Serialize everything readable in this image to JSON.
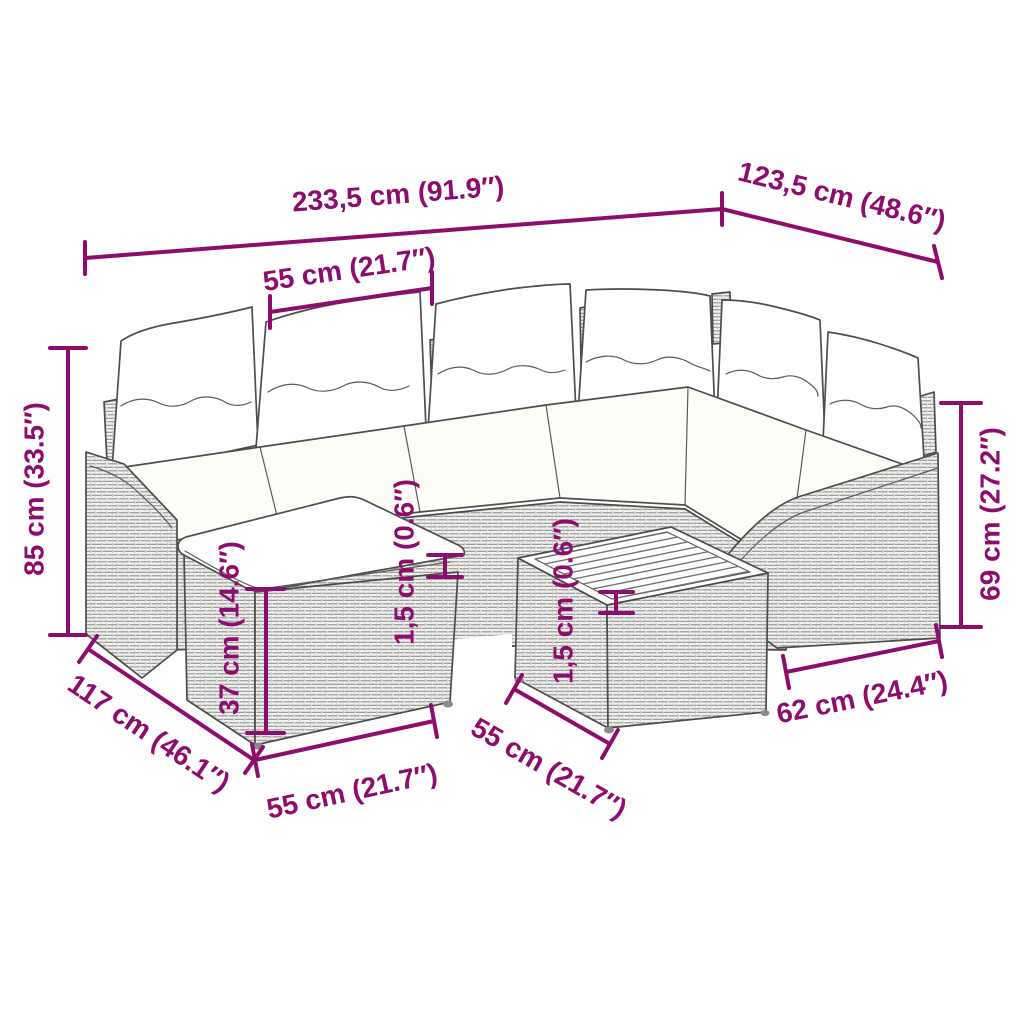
{
  "diagram": {
    "accent_color": "#8D0C6E",
    "outline_color": "#4b4b4b",
    "dimensions": {
      "total_width": "233,5 cm (91.9″)",
      "right_depth": "123,5 cm (48.6″)",
      "seat_width": "55 cm (21.7″)",
      "overall_height": "85 cm (33.5″)",
      "armrest_height": "69 cm (27.2″)",
      "footstool_height": "37 cm (14.6″)",
      "cushion_thickness": "1,5 cm (0.6″)",
      "tabletop_thickness": "1,5 cm (0.6″)",
      "left_depth": "117 cm (46.1″)",
      "footstool_width": "55 cm (21.7″)",
      "table_width": "55 cm (21.7″)",
      "armrest_section_width": "62 cm (24.4″)"
    }
  }
}
